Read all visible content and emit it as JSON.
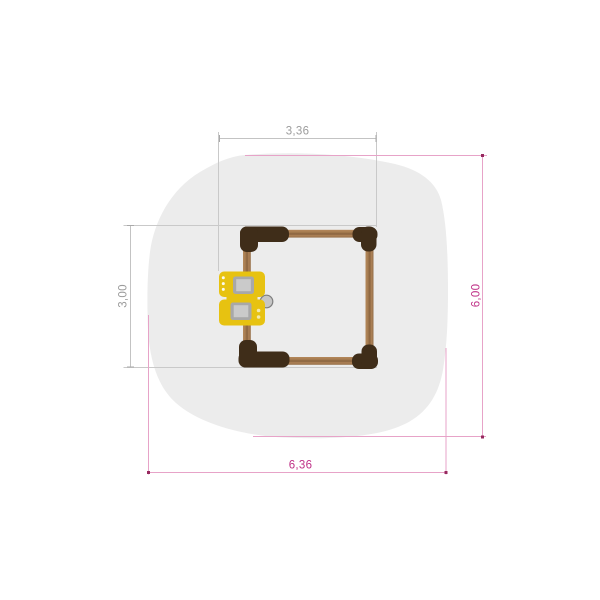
{
  "title": "Playground equipment plan view",
  "canvas": {
    "width": 600,
    "height": 600,
    "background": "#ffffff"
  },
  "dimensions": {
    "equipment_width": {
      "value": "3,36",
      "color": "#9C9C9C",
      "orientation": "horizontal",
      "position": "top"
    },
    "equipment_height": {
      "value": "3,00",
      "color": "#9C9C9C",
      "orientation": "vertical",
      "position": "left"
    },
    "safety_height": {
      "value": "6,00",
      "color": "#BF3187",
      "orientation": "vertical",
      "position": "right"
    },
    "safety_width": {
      "value": "6,36",
      "color": "#BF3187",
      "orientation": "horizontal",
      "position": "bottom"
    }
  },
  "elements": {
    "safety_area": {
      "shape": "organic-blob",
      "fill": "#ECECEC",
      "outline_color": "#E7A3C8",
      "tick_color": "#97295F"
    },
    "frame": {
      "shape": "square",
      "wood_color": "#A67C50",
      "corner_color": "#3F2D19",
      "construction_line_color": "#C9C9C9"
    },
    "play_panel": {
      "color": "#E7C211",
      "window_color": "#A8A8A8",
      "window_inner_color": "#CACACA",
      "knob_color": "#C6C6C6",
      "windows": 2
    }
  }
}
